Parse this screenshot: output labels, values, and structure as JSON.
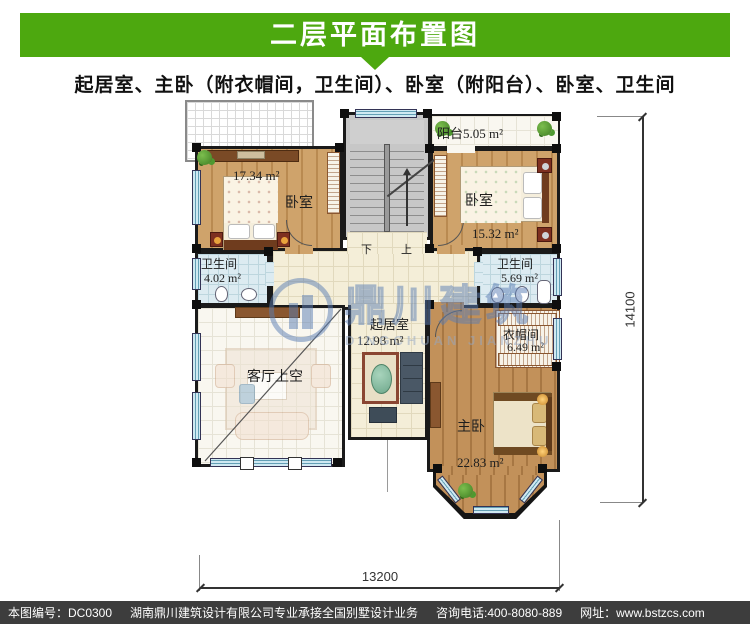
{
  "header": {
    "title": "二层平面布置图",
    "subtitle": "起居室、主卧（附衣帽间，卫生间）、卧室（附阳台）、卧室、卫生间",
    "accent_color": "#4DA80F"
  },
  "plan": {
    "rooms": {
      "balcony": {
        "label": "阳台5.05 m²"
      },
      "bedroom_left": {
        "name": "卧室",
        "area": "17.34 m²"
      },
      "bedroom_right": {
        "name": "卧室",
        "area": "15.32 m²"
      },
      "bath_left": {
        "name": "卫生间",
        "area": "4.02 m²"
      },
      "bath_right": {
        "name": "卫生间",
        "area": "5.69 m²"
      },
      "living": {
        "name": "起居室",
        "area": "12.93 m²"
      },
      "void": {
        "name": "客厅上空"
      },
      "cloakroom": {
        "name": "衣帽间",
        "area": "6.49 m²"
      },
      "master": {
        "name": "主卧",
        "area": "22.83 m²"
      }
    },
    "stair": {
      "down": "下",
      "up": "上"
    },
    "dimensions": {
      "width": "13200",
      "height": "14100"
    }
  },
  "watermark": {
    "cn": "鼎川建筑",
    "en": "DINGCHUAN JIANZHU"
  },
  "footer": {
    "items": [
      "本图编号：DC0300",
      "湖南鼎川建筑设计有限公司专业承接全国别墅设计业务",
      "咨询电话:400-8080-889",
      "网址：www.bstzcs.com"
    ]
  },
  "colors": {
    "header_green": "#4DA80F",
    "footer_bg": "#3D3D3D",
    "watermark_blue": "#5A7DB4"
  }
}
